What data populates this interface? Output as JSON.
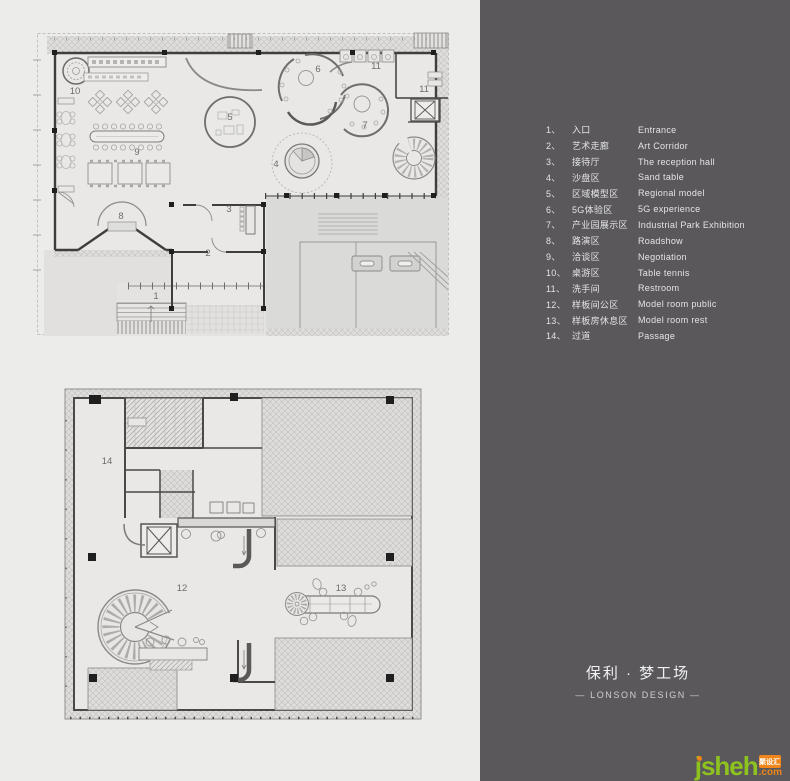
{
  "page": {
    "background": "#ececea"
  },
  "panel": {
    "background": "#5a585b",
    "legend": {
      "items": [
        {
          "num": "1、",
          "zh": "入口",
          "en": "Entrance"
        },
        {
          "num": "2、",
          "zh": "艺术走廊",
          "en": "Art Corridor"
        },
        {
          "num": "3、",
          "zh": "接待厅",
          "en": "The reception hall"
        },
        {
          "num": "4、",
          "zh": "沙盘区",
          "en": "Sand table"
        },
        {
          "num": "5、",
          "zh": "区域模型区",
          "en": "Regional model"
        },
        {
          "num": "6、",
          "zh": "5G体验区",
          "en": "5G experience"
        },
        {
          "num": "7、",
          "zh": "产业园展示区",
          "en": "Industrial Park Exhibition"
        },
        {
          "num": "8、",
          "zh": "路演区",
          "en": "Roadshow"
        },
        {
          "num": "9、",
          "zh": "洽谈区",
          "en": "Negotiation"
        },
        {
          "num": "10、",
          "zh": "桌游区",
          "en": "Table tennis"
        },
        {
          "num": "11、",
          "zh": "洗手间",
          "en": "Restroom"
        },
        {
          "num": "12、",
          "zh": "样板间公区",
          "en": "Model room public"
        },
        {
          "num": "13、",
          "zh": "样板房休息区",
          "en": "Model room rest"
        },
        {
          "num": "14、",
          "zh": "过道",
          "en": "Passage"
        }
      ]
    },
    "title": {
      "zh": "保利 · 梦工场",
      "en": "— LONSON DESIGN —"
    },
    "watermark": {
      "text": "jsheh",
      "badge": "聚设汇",
      "suffix": ".com",
      "green": "#8dc21f",
      "orange": "#f08619"
    }
  },
  "plans": {
    "plan1": {
      "name": "first-floor-plan",
      "labels": [
        {
          "n": "1",
          "x": 156,
          "y": 299
        },
        {
          "n": "2",
          "x": 208,
          "y": 256
        },
        {
          "n": "3",
          "x": 229,
          "y": 212
        },
        {
          "n": "4",
          "x": 276,
          "y": 167
        },
        {
          "n": "5",
          "x": 230,
          "y": 120
        },
        {
          "n": "6",
          "x": 318,
          "y": 72
        },
        {
          "n": "7",
          "x": 365,
          "y": 128
        },
        {
          "n": "8",
          "x": 121,
          "y": 219
        },
        {
          "n": "9",
          "x": 137,
          "y": 155
        },
        {
          "n": "10",
          "x": 75,
          "y": 94
        },
        {
          "n": "11",
          "x": 376,
          "y": 69
        },
        {
          "n": "11",
          "x": 424,
          "y": 92
        }
      ]
    },
    "plan2": {
      "name": "second-floor-plan",
      "labels": [
        {
          "n": "12",
          "x": 182,
          "y": 591
        },
        {
          "n": "13",
          "x": 341,
          "y": 591
        },
        {
          "n": "14",
          "x": 107,
          "y": 464
        }
      ]
    }
  }
}
